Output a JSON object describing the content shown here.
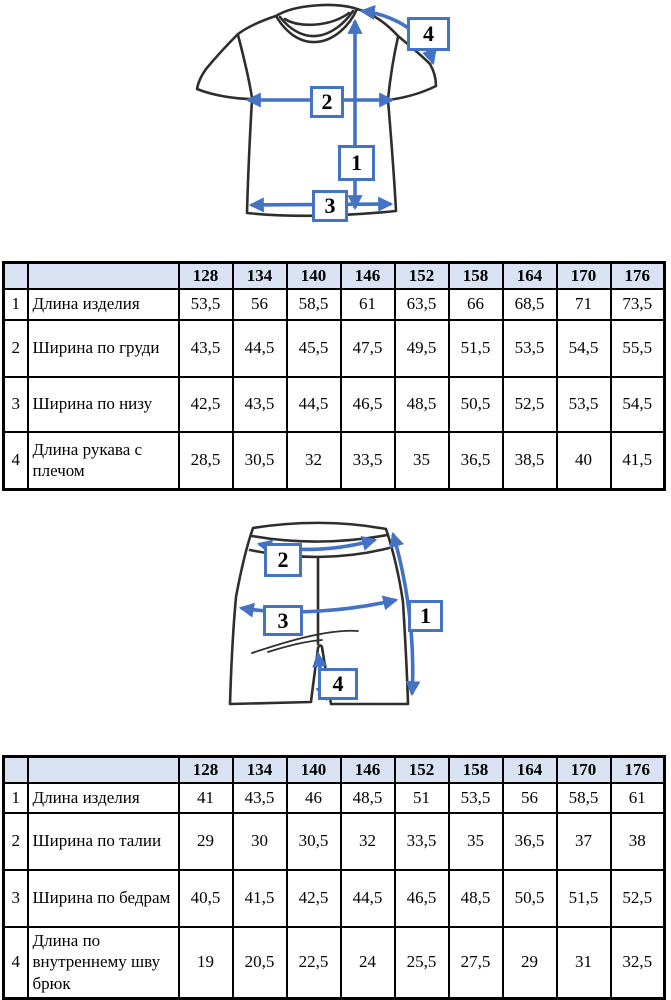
{
  "colors": {
    "accent_blue": "#4472c4",
    "table_header_bg": "#d9e2f3",
    "table_border": "#000000",
    "garment_outline": "#2e2e2e"
  },
  "tshirt_diagram": {
    "name": "t-shirt measurement scheme",
    "labels": [
      "1",
      "2",
      "3",
      "4"
    ]
  },
  "shorts_diagram": {
    "name": "shorts measurement scheme",
    "labels": [
      "1",
      "2",
      "3",
      "4"
    ]
  },
  "tshirt_table": {
    "sizes": [
      "128",
      "134",
      "140",
      "146",
      "152",
      "158",
      "164",
      "170",
      "176"
    ],
    "rows": [
      {
        "num": "1",
        "label": "Длина изделия",
        "values": [
          "53,5",
          "56",
          "58,5",
          "61",
          "63,5",
          "66",
          "68,5",
          "71",
          "73,5"
        ]
      },
      {
        "num": "2",
        "label": "Ширина по груди",
        "values": [
          "43,5",
          "44,5",
          "45,5",
          "47,5",
          "49,5",
          "51,5",
          "53,5",
          "54,5",
          "55,5"
        ]
      },
      {
        "num": "3",
        "label": "Ширина по низу",
        "values": [
          "42,5",
          "43,5",
          "44,5",
          "46,5",
          "48,5",
          "50,5",
          "52,5",
          "53,5",
          "54,5"
        ]
      },
      {
        "num": "4",
        "label": "Длина рукава с плечом",
        "values": [
          "28,5",
          "30,5",
          "32",
          "33,5",
          "35",
          "36,5",
          "38,5",
          "40",
          "41,5"
        ]
      }
    ]
  },
  "shorts_table": {
    "sizes": [
      "128",
      "134",
      "140",
      "146",
      "152",
      "158",
      "164",
      "170",
      "176"
    ],
    "rows": [
      {
        "num": "1",
        "label": "Длина изделия",
        "values": [
          "41",
          "43,5",
          "46",
          "48,5",
          "51",
          "53,5",
          "56",
          "58,5",
          "61"
        ]
      },
      {
        "num": "2",
        "label": "Ширина по талии",
        "values": [
          "29",
          "30",
          "30,5",
          "32",
          "33,5",
          "35",
          "36,5",
          "37",
          "38"
        ]
      },
      {
        "num": "3",
        "label": "Ширина по бедрам",
        "values": [
          "40,5",
          "41,5",
          "42,5",
          "44,5",
          "46,5",
          "48,5",
          "50,5",
          "51,5",
          "52,5"
        ]
      },
      {
        "num": "4",
        "label": "Длина по внутреннему шву брюк",
        "values": [
          "19",
          "20,5",
          "22,5",
          "24",
          "25,5",
          "27,5",
          "29",
          "31",
          "32,5"
        ]
      }
    ]
  }
}
